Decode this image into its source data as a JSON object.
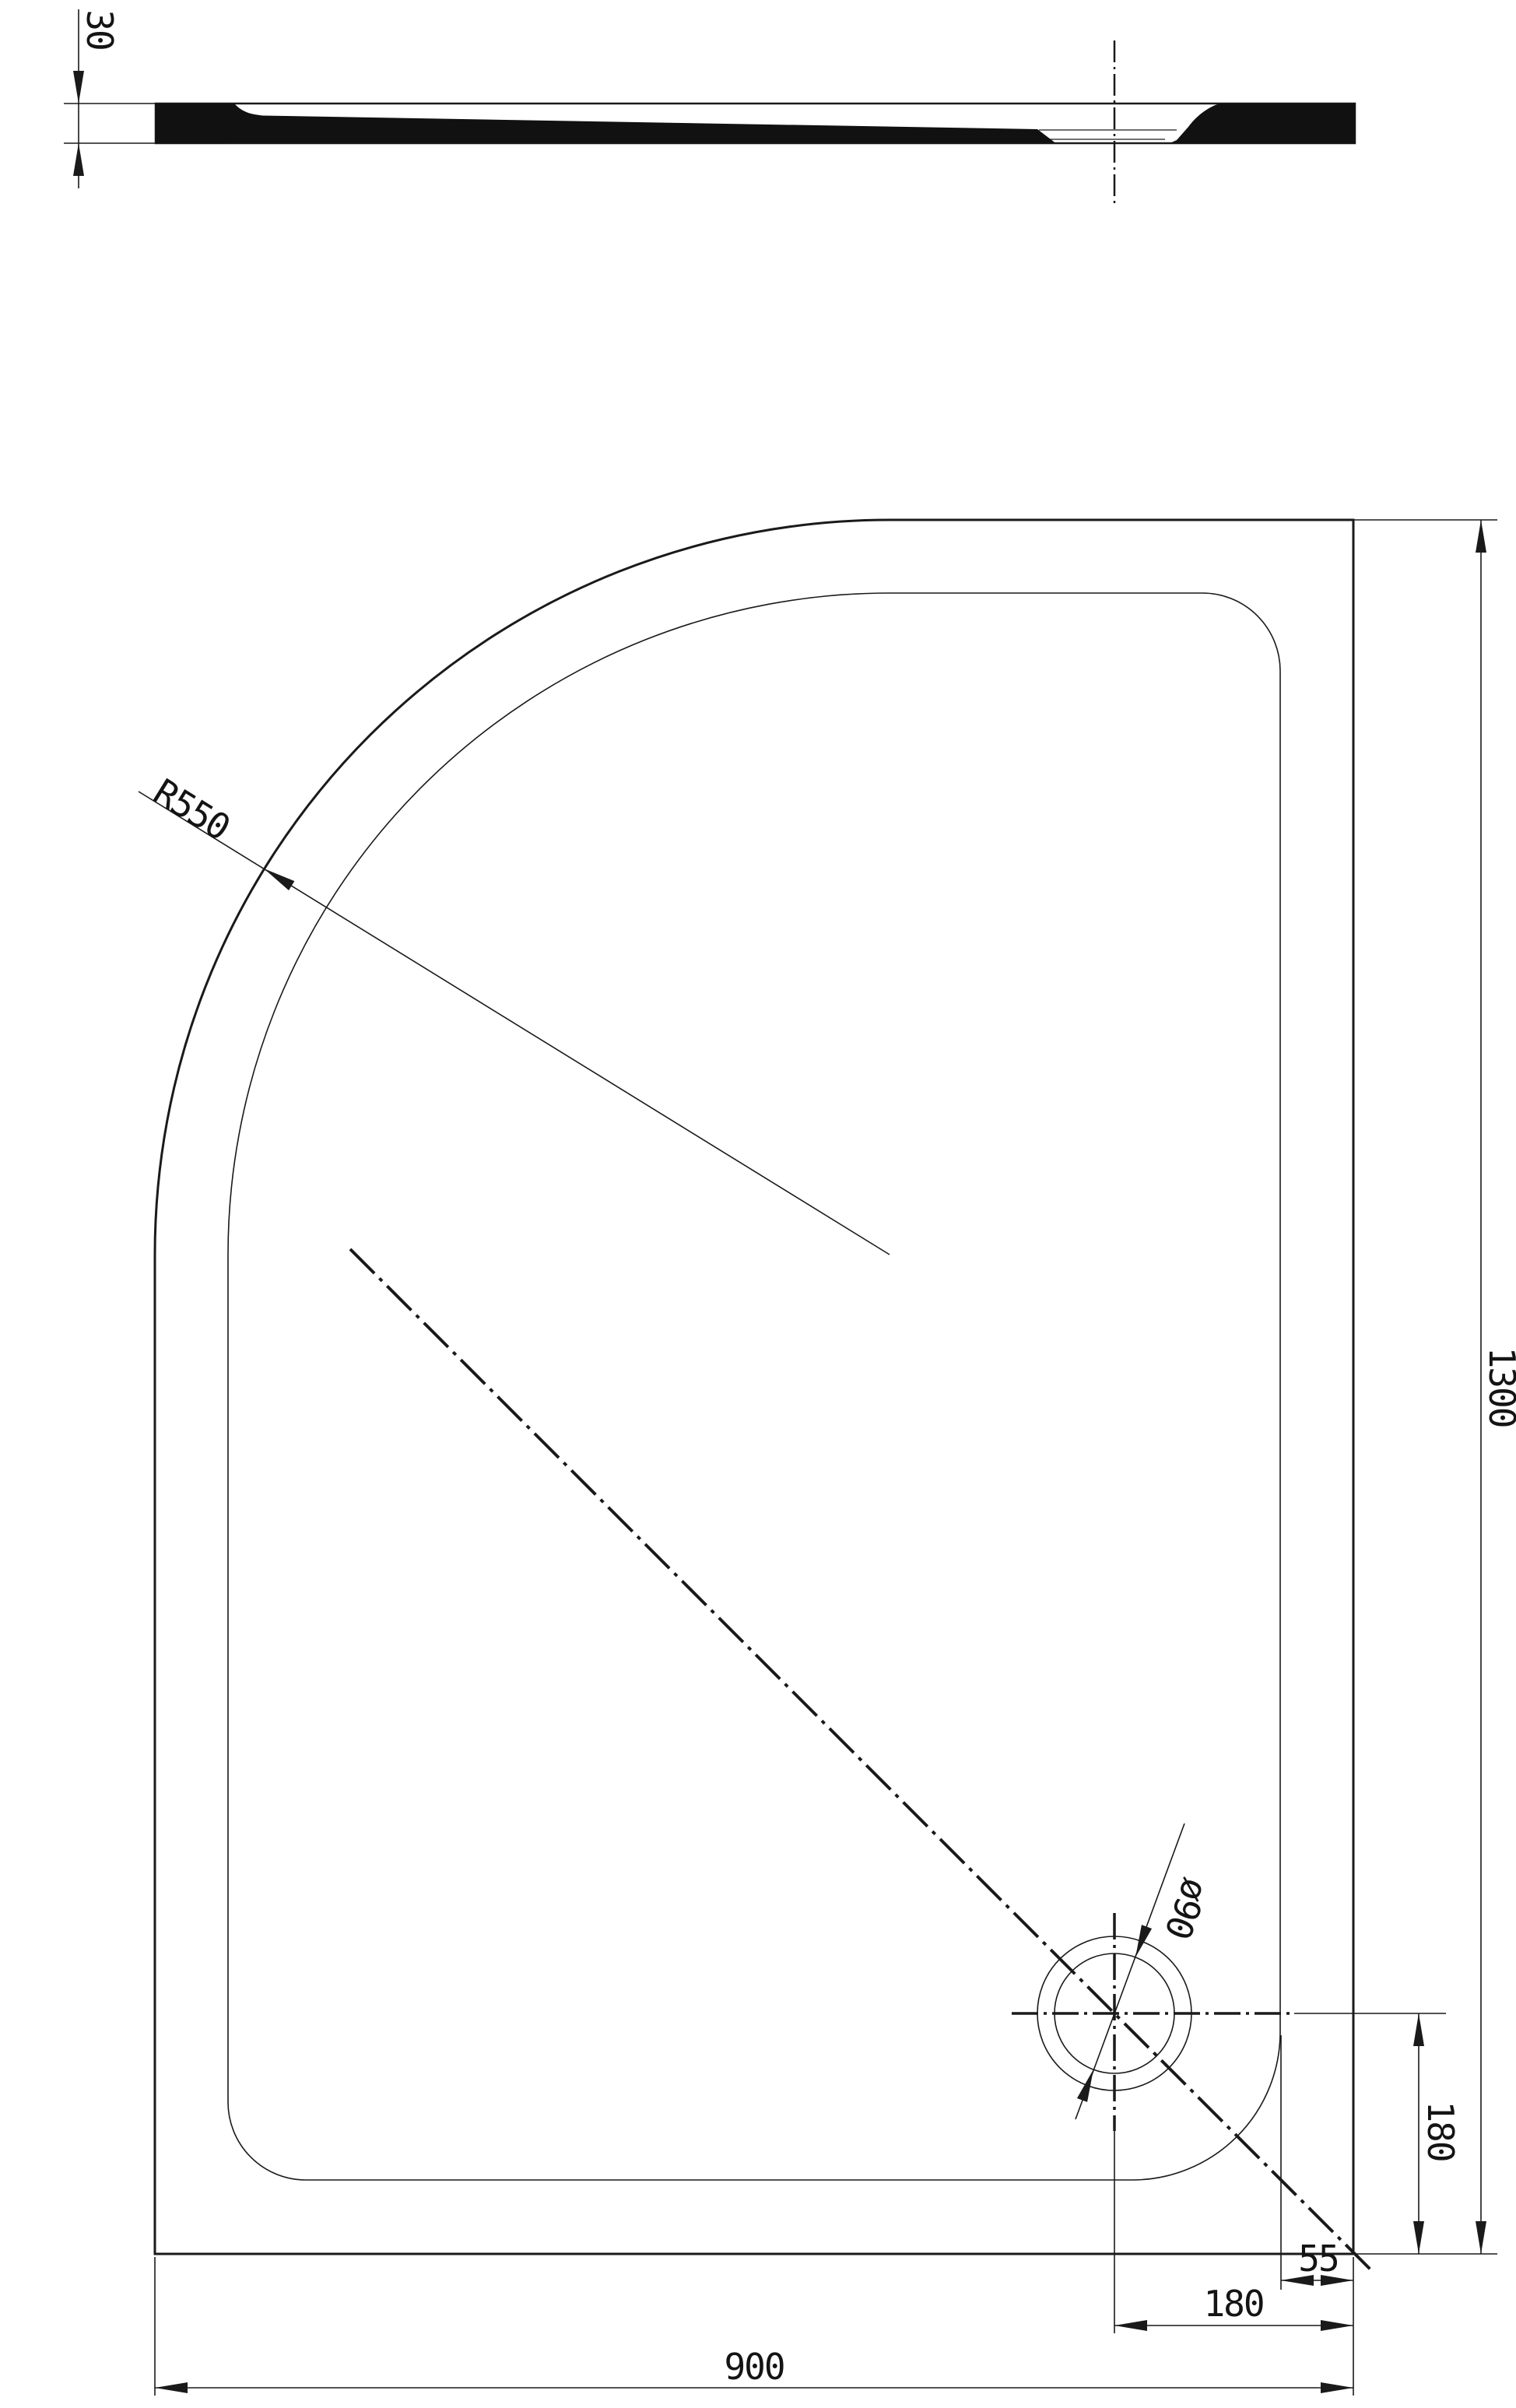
{
  "drawing": {
    "background": "#ffffff",
    "line_color": "#1a1a1a",
    "labels": {
      "profile_thickness": "30",
      "corner_radius": "R550",
      "drain_diameter": "ø90",
      "drain_offset_vertical": "180",
      "edge_inset": "55",
      "drain_offset_horizontal": "180",
      "tray_width": "900",
      "tray_length": "1300"
    }
  }
}
